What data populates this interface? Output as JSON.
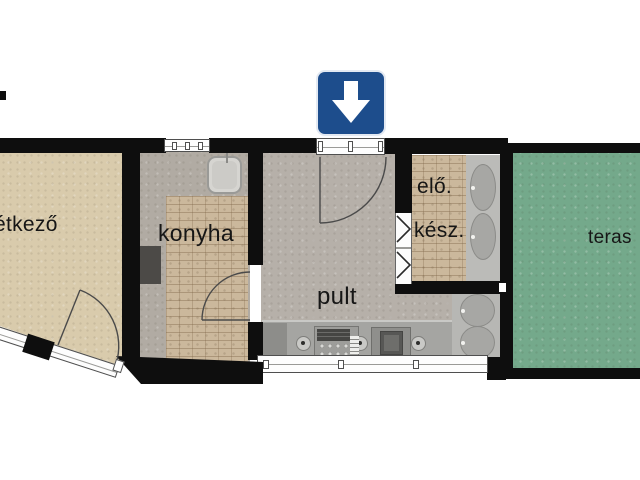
{
  "plan": {
    "type": "apartment-floor-plan",
    "rooms": {
      "dining": {
        "label": "étkező"
      },
      "kitchen": {
        "label": "konyha"
      },
      "counter": {
        "label": "pult"
      },
      "hall": {
        "label": "elő."
      },
      "pantry": {
        "label": "kész."
      },
      "terrace": {
        "label": "teras"
      }
    },
    "sign": {
      "name": "entrance-direction-sign",
      "symbol": "down-arrow"
    }
  },
  "colors": {
    "wall": "#0e0e0e",
    "dining_floor": "#d9cbac",
    "kitchen_floor": "#b1aba3",
    "counter_floor": "#b6b0a9",
    "brick": "#cbb89c",
    "terrace": "#74a98b",
    "counter_top": "#a5a5a2",
    "sign_blue": "#1d4d8c"
  }
}
